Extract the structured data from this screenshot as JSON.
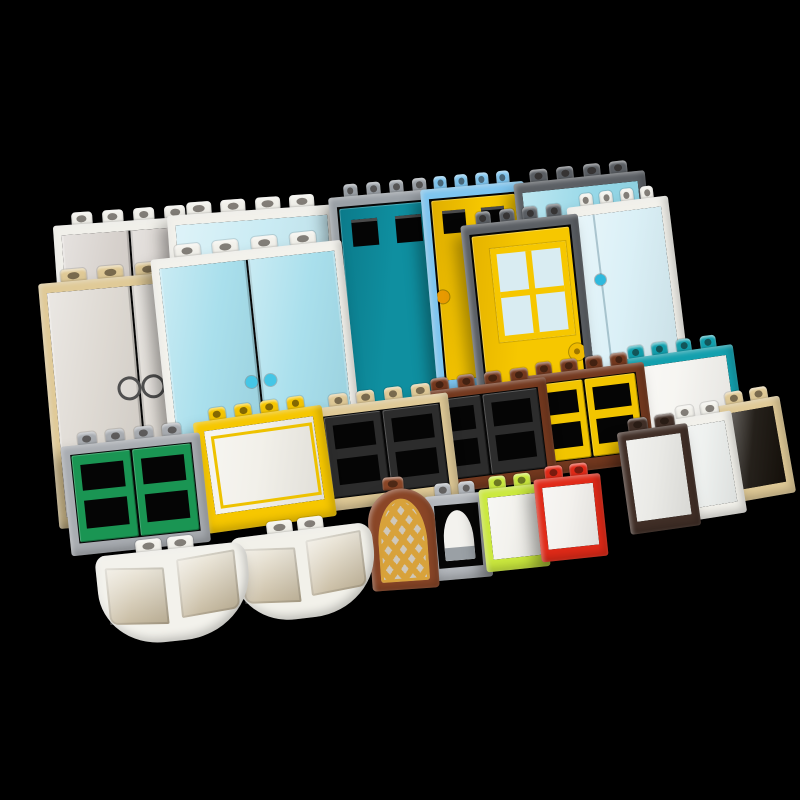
{
  "scene": {
    "title": "Assorted LEGO door and window bricks on a black background",
    "background": "#000000",
    "canvas": {
      "w": 800,
      "h": 800
    },
    "palette": {
      "white": "#f1f0ea",
      "tan": "#e0ca97",
      "light_gray": "#a9adb2",
      "medium_gray": "#9aa0a6",
      "dark_gray": "#5b5f64",
      "azure": "#7ec5ef",
      "yellow": "#f6c700",
      "dark_turquoise": "#13a0ae",
      "turquoise_door": "#0f8fa0",
      "green": "#1a9553",
      "black": "#2c2c2c",
      "reddish_brown": "#74391f",
      "arch_brown": "#8a4627",
      "pearl_gold": "#d8a23b",
      "dark_brown": "#412f27",
      "red": "#e12a18",
      "lime": "#cbe93e",
      "trans_clear": "#dcd7d0",
      "trans_light_blue": "#a3ddeb"
    },
    "pieces": [
      {
        "id": "p1",
        "name": "door-frame-white-trans-black-doors",
        "type": "doors2",
        "x": 52,
        "y": 214,
        "w": 152,
        "h": 240,
        "rot": -4,
        "studs": 4,
        "frame": "#f1f0ea",
        "glass": "#d4cec9"
      },
      {
        "id": "p3",
        "name": "panel-white-trans-light-blue",
        "type": "panel",
        "x": 166,
        "y": 204,
        "w": 168,
        "h": 230,
        "rot": -4,
        "studs": 4,
        "frame": "#f2f1eb",
        "glass": "#c6eaf3"
      },
      {
        "id": "p5",
        "name": "door-frame-gray-dark-turquoise-door",
        "type": "door_win2",
        "x": 327,
        "y": 186,
        "w": 115,
        "h": 240,
        "rot": -5,
        "studs": 4,
        "frame": "#9aa0a6",
        "door": "#0f8fa0",
        "doorDark": "#0b7a8a",
        "hole": "#050505",
        "handle": "#35b5d5",
        "handleSide": "right"
      },
      {
        "id": "p6",
        "name": "door-frame-azure-yellow-door",
        "type": "door_win2",
        "x": 419,
        "y": 178,
        "w": 104,
        "h": 215,
        "rot": -5,
        "studs": 4,
        "frame": "#7ec5ef",
        "door": "#f6c700",
        "doorDark": "#dfae00",
        "hole": "#050505",
        "handle": "#e89a00",
        "handleSide": "left"
      },
      {
        "id": "p7",
        "name": "panel-dark-gray-trans-light-blue",
        "type": "panel",
        "x": 512,
        "y": 172,
        "w": 132,
        "h": 225,
        "rot": -6,
        "studs": 4,
        "frame": "#5b5f64",
        "glass": "#8ed5e6"
      },
      {
        "id": "p2",
        "name": "door-frame-tan-trans-clear-doors",
        "type": "doors2",
        "x": 37,
        "y": 272,
        "w": 184,
        "h": 258,
        "rot": -5,
        "studs": 4,
        "frame": "#e0ca97",
        "glass": "#dcd7d0",
        "handle": "#4f4f4f",
        "handleStyle": "rings"
      },
      {
        "id": "p4",
        "name": "door-frame-white-trans-light-blue-doors",
        "type": "doors2",
        "x": 149,
        "y": 248,
        "w": 192,
        "h": 256,
        "rot": -6,
        "studs": 4,
        "frame": "#f3f2ec",
        "glass": "#a3ddeb",
        "handle": "#45c6e6",
        "handleStyle": "dots"
      },
      {
        "id": "p9",
        "name": "door-frame-white-trans-light-blue-door",
        "type": "glass_door",
        "x": 565,
        "y": 196,
        "w": 102,
        "h": 208,
        "rot": -7,
        "studs": 4,
        "frame": "#f2f1eb",
        "glass": "#d8eff6",
        "handle": "#2fb9dd"
      },
      {
        "id": "p8",
        "name": "door-dark-gray-frame-yellow-4-pane-door",
        "type": "door_win4",
        "x": 459,
        "y": 214,
        "w": 118,
        "h": 268,
        "rot": -6,
        "studs": 4,
        "frame": "#5b5f64",
        "door": "#f6c700",
        "doorDark": "#e5b300",
        "pane": "#d9ecf2",
        "handle": "#f0bb00",
        "handleSide": "right"
      },
      {
        "id": "m6",
        "name": "window-dark-turquoise-frame-white-glass",
        "type": "panel",
        "x": 611,
        "y": 349,
        "w": 121,
        "h": 113,
        "rot": -8,
        "studs": 4,
        "frame": "#13a0ae",
        "glass": "#f6f5f1"
      },
      {
        "id": "m5",
        "name": "window-reddish-brown-yellow-sashes",
        "type": "sash2",
        "x": 519,
        "y": 365,
        "w": 124,
        "h": 113,
        "rot": -7,
        "studs": 4,
        "frame": "#74391f",
        "sash": "#f2c500",
        "hole": "#050505"
      },
      {
        "id": "m4",
        "name": "window-reddish-brown-black-sashes",
        "type": "sash2",
        "x": 413,
        "y": 381,
        "w": 132,
        "h": 115,
        "rot": -7,
        "studs": 4,
        "frame": "#74391f",
        "sash": "#2c2c2c",
        "hole": "#050505"
      },
      {
        "id": "m3",
        "name": "window-tan-black-sashes",
        "type": "sash2",
        "x": 311,
        "y": 397,
        "w": 136,
        "h": 116,
        "rot": -7,
        "studs": 4,
        "frame": "#e0ca97",
        "sash": "#2c2c2c",
        "hole": "#050505"
      },
      {
        "id": "m2",
        "name": "train-window-yellow",
        "type": "train",
        "x": 191,
        "y": 411,
        "w": 130,
        "h": 124,
        "rot": -8,
        "studs": 4,
        "frame": "#f6c700",
        "glass": "#f1efe8",
        "inner": "#eec200"
      },
      {
        "id": "m1",
        "name": "window-gray-green-sashes",
        "type": "sash2",
        "x": 59,
        "y": 435,
        "w": 140,
        "h": 122,
        "rot": -6,
        "studs": 4,
        "frame": "#a9adb2",
        "sash": "#1a9553",
        "hole": "#050505"
      },
      {
        "id": "f7",
        "name": "window-small-tan-empty",
        "type": "small",
        "x": 713,
        "y": 395,
        "w": 65,
        "h": 110,
        "rot": -10,
        "studs": 2,
        "frame": "#e0ca97",
        "glass": "#15100a"
      },
      {
        "id": "f6",
        "name": "window-small-white",
        "type": "small",
        "x": 663,
        "y": 409,
        "w": 67,
        "h": 115,
        "rot": -9,
        "studs": 2,
        "frame": "#f2f1eb",
        "glass": "#edf0ee"
      },
      {
        "id": "f5",
        "name": "window-small-dark-brown",
        "type": "small",
        "x": 615,
        "y": 421,
        "w": 71,
        "h": 115,
        "rot": -8,
        "studs": 2,
        "frame": "#412f27",
        "glass": "#e8e8e4"
      },
      {
        "id": "f2",
        "name": "window-small-gray-arched",
        "type": "arch_open",
        "x": 423,
        "y": 485,
        "w": 62,
        "h": 97,
        "rot": -5,
        "studs": 2,
        "frame": "#b4b8bd",
        "glass": "#f3f2ee",
        "sill": "#9aa0a5"
      },
      {
        "id": "f3",
        "name": "window-small-lime",
        "type": "small",
        "x": 477,
        "y": 478,
        "w": 64,
        "h": 95,
        "rot": -6,
        "studs": 2,
        "frame": "#cbe93e",
        "glass": "#f2f1ec"
      },
      {
        "id": "f4",
        "name": "window-small-red",
        "type": "small",
        "x": 532,
        "y": 468,
        "w": 67,
        "h": 95,
        "rot": -6,
        "studs": 2,
        "frame": "#e12a18",
        "glass": "#f2f0ec"
      },
      {
        "id": "f1",
        "name": "arch-window-brown-gold-lattice",
        "type": "arch_lattice",
        "x": 365,
        "y": 479,
        "w": 67,
        "h": 113,
        "rot": -4,
        "studs": 1,
        "frame": "#8a4627",
        "lattice": "#d8a23b",
        "backdrop": "#cfc8bb"
      },
      {
        "id": "b2",
        "name": "bow-window-white-right",
        "type": "bow",
        "x": 227,
        "y": 527,
        "w": 143,
        "h": 100,
        "rot": -7,
        "studs": 2,
        "frame": "#f2f1ea",
        "glass_top": "#ece7da",
        "glass_bottom": "#c6b99e"
      },
      {
        "id": "b1",
        "name": "bow-window-white-left",
        "type": "bow",
        "x": 93,
        "y": 545,
        "w": 152,
        "h": 104,
        "rot": -6,
        "studs": 2,
        "frame": "#f3f2ec",
        "glass_top": "#ece7da",
        "glass_bottom": "#c3b69b"
      }
    ]
  }
}
